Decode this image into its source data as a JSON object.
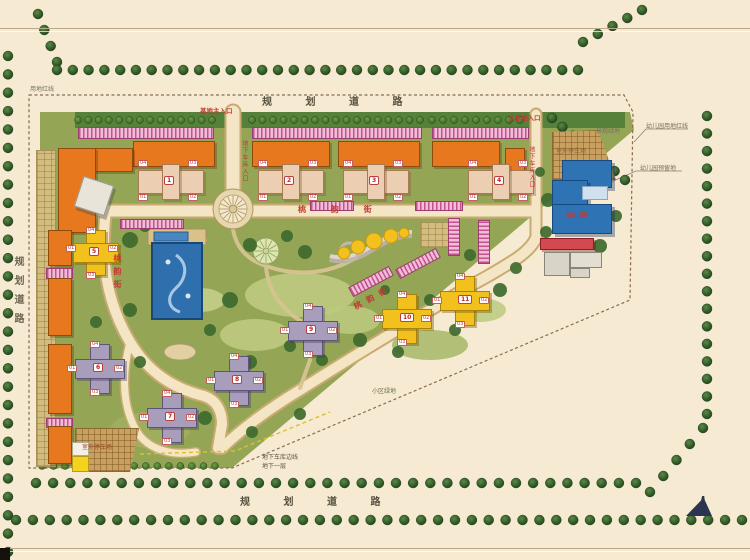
{
  "road_labels": {
    "top": "规 划 道 路",
    "bottom": "规 划 道 路",
    "left": "规划道路"
  },
  "street_names": {
    "main": "桃 韵 街",
    "west": "桃韵街",
    "south": "桃韵街"
  },
  "entrances": {
    "main": "基地主入口",
    "secondary": "次基地入口",
    "garage_main": "地下车库入口",
    "garage_secondary": "地下车库入口"
  },
  "boundary_labels": {
    "site": "用地红线",
    "kindergarten": "幼儿园用地红线",
    "garage_edge": "地下车库边线",
    "garage_floor": "地下一层"
  },
  "area_labels": {
    "kindergarten": "幼儿园",
    "kindergarten_reserved": "幼儿园预留地",
    "outdoor_parking_ne": "室外停车场",
    "outdoor_parking_sw": "室外停车场",
    "landscape_green": "景观绿地",
    "community_green": "小区绿地"
  },
  "buildings": {
    "unit_chips": [
      "04",
      "03",
      "01",
      "02"
    ],
    "clusters": [
      {
        "num": "1"
      },
      {
        "num": "2"
      },
      {
        "num": "3"
      },
      {
        "num": "4"
      }
    ],
    "towers": [
      {
        "num": "5"
      },
      {
        "num": "6"
      },
      {
        "num": "7"
      },
      {
        "num": "8"
      },
      {
        "num": "9"
      },
      {
        "num": "10"
      },
      {
        "num": "11"
      }
    ]
  },
  "colors": {
    "terrain_green": "#94a656",
    "tree_dark": "#2c5428",
    "road_cream": "#f4e6c4",
    "building_orange": "#e8781e",
    "tower_gray": "#a89dbb",
    "tower_yellow": "#f2c11e",
    "kindergarten_blue": "#2e74b5",
    "parking_pink": "#e9a8cc",
    "label_red": "#c23a32",
    "pool_blue": "#2f6fae",
    "boundary_line": "#8a6a55"
  }
}
